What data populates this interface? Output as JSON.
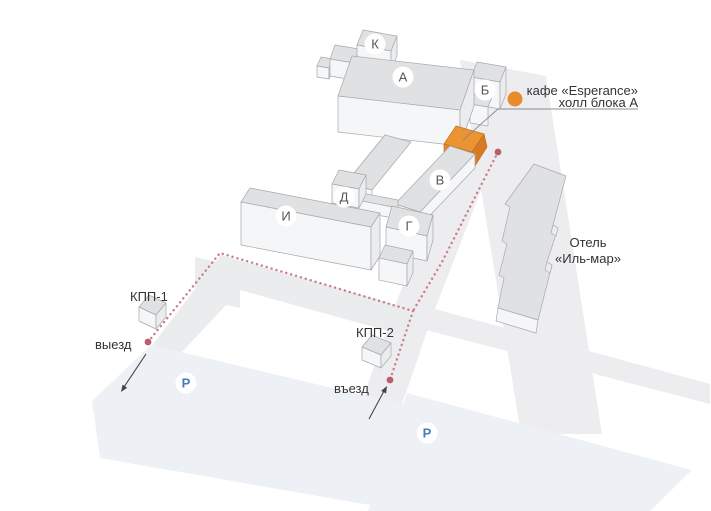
{
  "map": {
    "building_labels": [
      {
        "id": "K",
        "letter": "К"
      },
      {
        "id": "A",
        "letter": "А"
      },
      {
        "id": "B",
        "letter": "Б"
      },
      {
        "id": "V",
        "letter": "В"
      },
      {
        "id": "D",
        "letter": "Д"
      },
      {
        "id": "I",
        "letter": "И"
      },
      {
        "id": "G",
        "letter": "Г"
      }
    ],
    "cafe_callout": {
      "line1": "кафе «Esperance»",
      "line2": "холл блока А"
    },
    "hotel_label": {
      "line1": "Отель",
      "line2": "«Иль-мар»"
    },
    "checkpoints": {
      "kpp1": "КПП-1",
      "kpp2": "КПП-2"
    },
    "gates": {
      "exit": "выезд",
      "entrance": "въезд"
    },
    "parking_symbol": "P",
    "colors": {
      "cafe_accent_orange": "#E8872C",
      "route_dotted_pink": "#CA7F8A",
      "waypoint_red": "#B65F6D",
      "parking_blue": "#4A7AB8",
      "building_top_gray": "#DFE1E3",
      "building_front_gray": "#F5F6F7"
    }
  }
}
